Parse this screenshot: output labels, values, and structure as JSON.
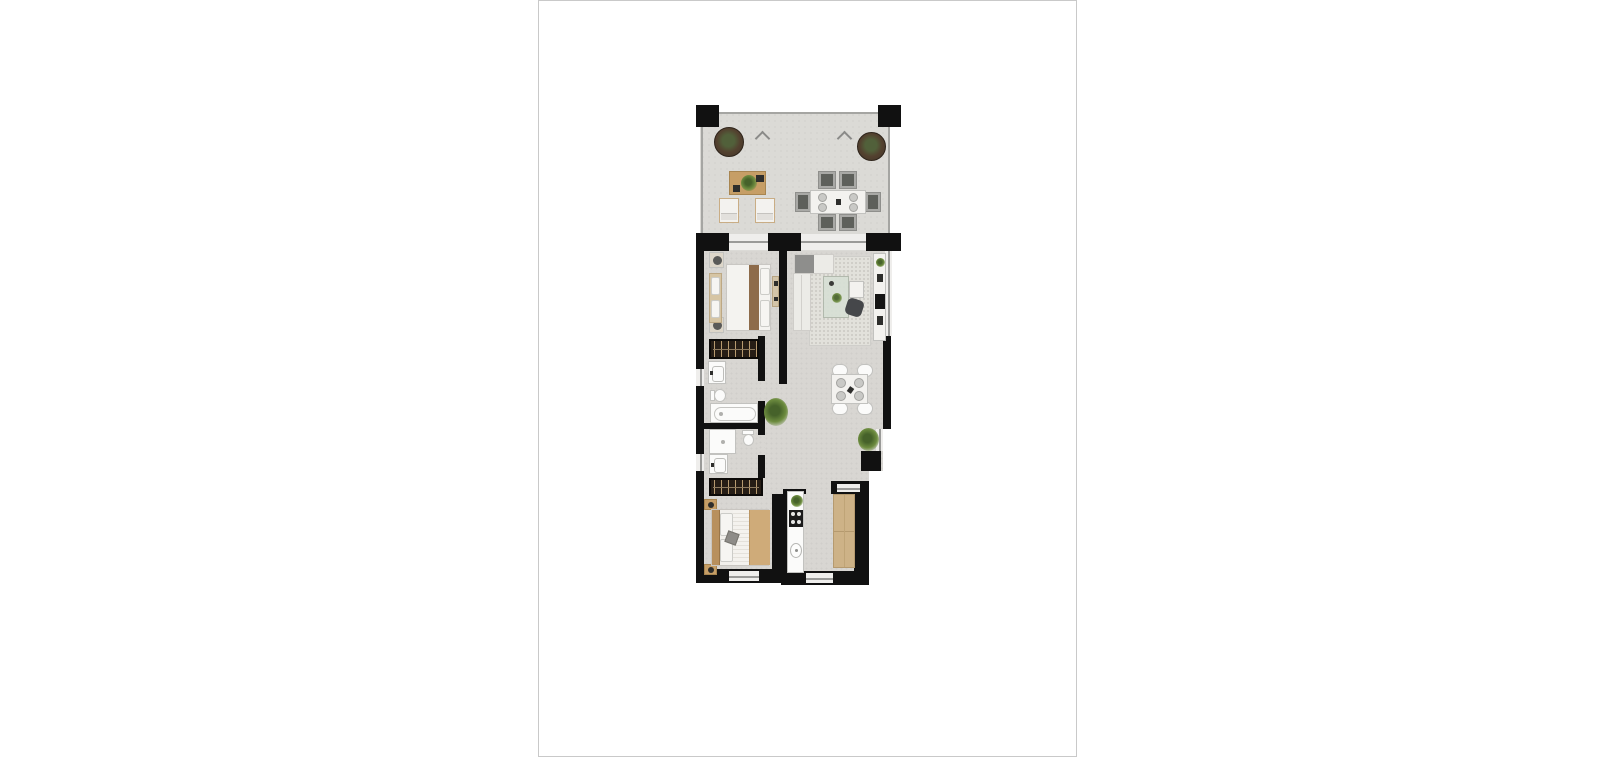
{
  "page": {
    "background": "#ffffff",
    "border_color": "#c9c9c9",
    "content": "architectural floor plan rendering, no text labels visible"
  },
  "floor_plan": {
    "type": "apartment-floor-plan-top-view",
    "colors": {
      "page_border": "#c9c9c9",
      "wall": "#111111",
      "floor": "#d8d6d2",
      "terrace_floor": "#dbdad6",
      "railing": "#a5a5a2",
      "window_line": "#9a9a98",
      "white_furniture": "#f3f2ef",
      "fixture_white": "#fbfbfa",
      "fixture_border": "#c2c2bf",
      "wood": "#c69e66",
      "wood_dark": "#a88550",
      "oak_counter": "#cdb287",
      "wardrobe_dark": "#261d15",
      "wardrobe_stripe": "#b79a6f",
      "sofa": "#ecebe7",
      "rug": "#e2e1db",
      "glass": "#d8dfd5",
      "plant": "#6d8c3f",
      "plant_dark": "#46622a",
      "planter": "#3f3328",
      "duvet_tan": "#cfab79",
      "blanket_brown": "#8d6b4a",
      "chair_gray": "#a9a9a6",
      "cushion_dark": "#5e605b",
      "tv_black": "#141414",
      "accent_dark": "#2e2e2c"
    },
    "rooms": [
      "terrace",
      "bedroom-2",
      "living-room",
      "hallway",
      "bathroom-1",
      "bathroom-2",
      "dining-area",
      "master-bedroom",
      "kitchen"
    ],
    "furniture": {
      "terrace": [
        "round-planter",
        "round-planter",
        "coffee-table-with-plant",
        "lounge-chair",
        "lounge-chair",
        "dining-table-6-seats"
      ],
      "bedroom_2": [
        "double-bed-with-brown-runner",
        "nightstand-with-lamp",
        "nightstand-with-lamp",
        "bench",
        "dresser"
      ],
      "living_room": [
        "l-shaped-sofa",
        "area-rug",
        "glass-coffee-table-with-plant",
        "side-table",
        "dark-armchair",
        "tv-console-with-plant"
      ],
      "bathroom_1": [
        "vanity-sink",
        "toilet",
        "bathtub"
      ],
      "bathroom_2": [
        "shower-tray",
        "toilet",
        "vanity-sink"
      ],
      "hallway": [
        "green-plant",
        "wardrobe",
        "wardrobe"
      ],
      "dining_area": [
        "square-table-4-seats",
        "green-plant"
      ],
      "master_bedroom": [
        "double-bed-wood-headboard",
        "nightstand",
        "nightstand"
      ],
      "kitchen": [
        "counter-strip",
        "cooktop-4-burners",
        "kitchen-sink",
        "plant",
        "oak-counter"
      ]
    }
  }
}
